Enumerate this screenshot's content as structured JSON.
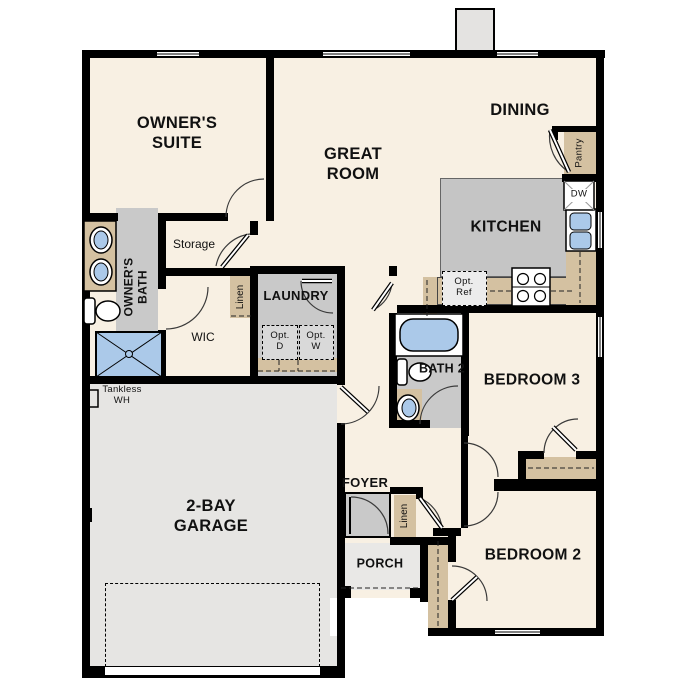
{
  "title": "Single-story 3-bedroom floor plan",
  "labels": {
    "owners_suite": "OWNER'S SUITE",
    "great_room": "GREAT ROOM",
    "dining": "DINING",
    "kitchen": "KITCHEN",
    "owners_bath": "OWNER'S BATH",
    "storage": "Storage",
    "wic": "WIC",
    "linen_wic": "Linen",
    "linen_hall": "Linen",
    "laundry": "LAUNDRY",
    "opt_dryer": "Opt. D",
    "opt_washer": "Opt. W",
    "opt_ref": "Opt. Ref",
    "pantry": "Pantry",
    "dishwasher": "DW",
    "bath2": "BATH 2",
    "bedroom3": "BEDROOM 3",
    "bedroom2": "BEDROOM 2",
    "foyer": "FOYER",
    "porch": "PORCH",
    "garage": "2-BAY GARAGE",
    "tankless_wh": "Tankless WH"
  },
  "colors": {
    "floor": "#f8f0e3",
    "wet_room_gray": "#c9c9c9",
    "counter_tan": "#d4c1a1",
    "fixture_blue": "#abc9e9",
    "garage_gray": "#e6e5e3",
    "wall_black": "#000000"
  }
}
